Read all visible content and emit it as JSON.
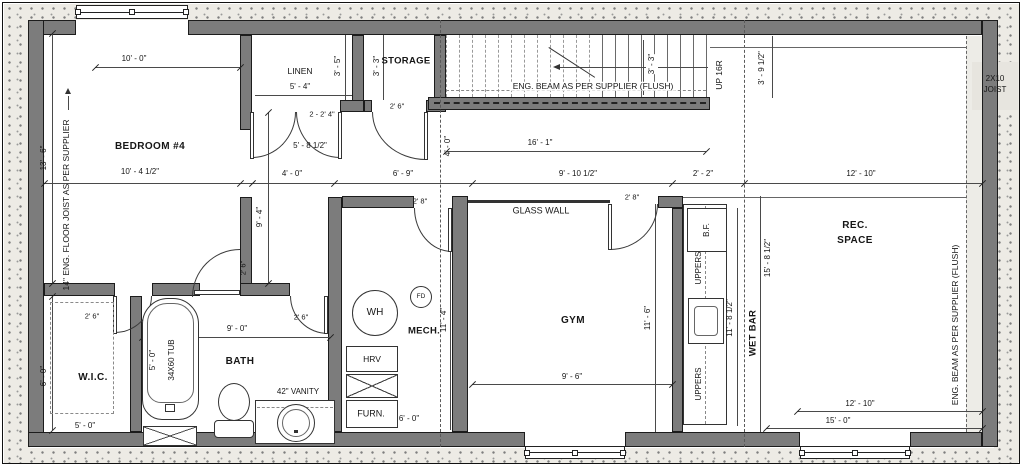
{
  "plan": {
    "rooms": {
      "bedroom4": "BEDROOM #4",
      "linen": "LINEN",
      "storage": "STORAGE",
      "wic": "W.I.C.",
      "bath": "BATH",
      "mech": "MECH.",
      "gym": "GYM",
      "wet_bar": "WET BAR",
      "rec_line1": "REC.",
      "rec_line2": "SPACE"
    },
    "fixtures": {
      "water_heater": "WH",
      "floor_drain": "FD",
      "hrv": "HRV",
      "furnace": "FURN.",
      "tub": "34X60 TUB",
      "vanity": "42\" VANITY",
      "bar_fridge": "B.F.",
      "uppers_upper": "UPPERS",
      "uppers_lower": "UPPERS"
    },
    "notes": {
      "glass_wall": "GLASS WALL",
      "stair_beam": "ENG. BEAM AS PER SUPPLIER (FLUSH)",
      "right_beam": "ENG. BEAM AS PER SUPPLIER (FLUSH)",
      "floor_joist": "14\" ENG. FLOOR JOIST AS PER SUPPLIER",
      "joist_2x10_line1": "2X10",
      "joist_2x10_line2": "JOIST",
      "stair_direction": "UP 16R"
    },
    "dimensions": {
      "bedroom_width": "10' - 0\"",
      "bedroom_width_lower": "10' - 4 1/2\"",
      "bedroom_depth": "13' - 6\"",
      "linen_width": "5' - 4\"",
      "linen_depth": "3' - 5\"",
      "storage_depth": "3' - 3\"",
      "storage_door": "2' 6\"",
      "hall_double_door": "2 - 2' 4\"",
      "hall_double_width": "5' - 8 1/2\"",
      "hall_width": "4' - 0\"",
      "hall_length": "9' - 4\"",
      "landing_width": "4' - 0\"",
      "stair_length": "16' - 1\"",
      "stair_width": "3' - 3\"",
      "stair_offset": "3' - 9 1/2\"",
      "row_6_9": "6' - 9\"",
      "row_9_10": "9' - 10 1/2\"",
      "row_2_2": "2' - 2\"",
      "row_12_10": "12' - 10\"",
      "wic_width": "5' - 0\"",
      "wic_depth": "6' - 0\"",
      "wic_door": "2' 6\"",
      "bedroom_door": "2' 6\"",
      "tub_length": "5' - 0\"",
      "bath_width": "9' - 0\"",
      "bath_door": "2' 6\"",
      "mech_door": "2' 8\"",
      "mech_depth": "11' - 4\"",
      "furnace_clear": "6' - 0\"",
      "gym_door": "2' 8\"",
      "gym_width": "9' - 6\"",
      "gym_depth": "11' - 6\"",
      "wetbar_length": "11' - 8 1/2\"",
      "wetbar_total": "15' - 8 1/2\"",
      "rec_width_top": "12' - 10\"",
      "rec_width_bottom": "12' - 10\"",
      "rec_total": "15' - 0\""
    }
  }
}
